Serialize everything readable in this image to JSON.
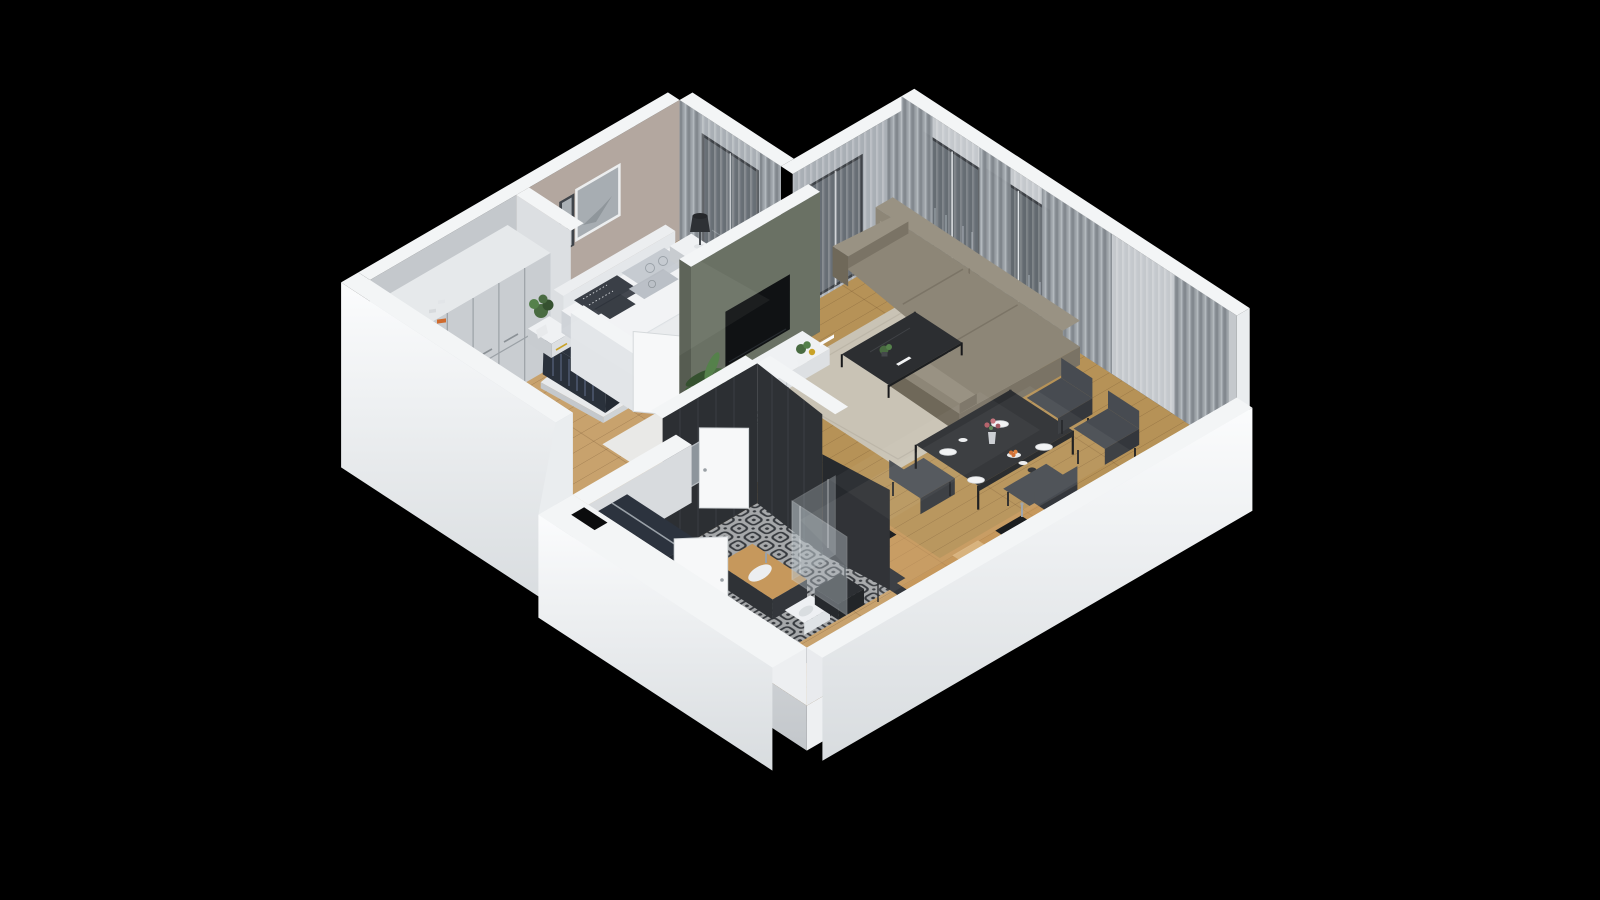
{
  "meta": {
    "kind": "isometric-3d-floor-plan-render",
    "view": "dollhouse cutaway, walls sliced, black backdrop"
  },
  "icons": {
    "freezer_icon": "❄"
  },
  "palette": {
    "bg": "#000000",
    "wallTop": "#f3f5f6",
    "wallFaceLight": "#eaedef",
    "wallFaceShade": "#d3d7db",
    "wallInner": "#c4c8cc",
    "wallInnerDark": "#a6acb2",
    "taupe": "#b3a79f",
    "olive": "#6a7164",
    "oliveDark": "#565c51",
    "woodBedroom": "#c49b66",
    "woodLiving": "#b69257",
    "woodHall": "#c8a26d",
    "plankLine": "#5a3c1e",
    "tileBase": "#c6c9cb",
    "tileInk": "#41454a",
    "rugLiving": "#c9c3b5",
    "rugBed": "#e9e9e7",
    "bedWhite": "#f2f3f5",
    "bedShade": "#d9dce0",
    "headboard": "#e4e7ea",
    "pillowDark": "#3a3f47",
    "pillowLight": "#c6cbd1",
    "sofa": "#8d8677",
    "sofaShade": "#7a7365",
    "sofaDark": "#6f6859",
    "sofaLight": "#999283",
    "tableDark": "#2c2e31",
    "chair": "#474b51",
    "chairDark": "#34373c",
    "counterWood": "#c6985c",
    "cabinetDark": "#33363b",
    "fridgeWhite": "#eef0f3",
    "fridgeShade": "#d4d8dc",
    "curtain": "#9ba1a7",
    "curtainDark": "#80868c",
    "sheerLight": "#d9dde0",
    "glass": "#5d646b",
    "glassLight": "#99a1a8",
    "frameDark": "#2e3237",
    "plantGreen": "#496b41",
    "plantDark": "#35512f",
    "potDark": "#3a3d40",
    "accentOrange": "#cf6a2d",
    "accentRed": "#a93c30",
    "denim": "#48587a",
    "clothesDark": "#2c333e",
    "metal": "#9aa1a8",
    "black": "#0b0c0d",
    "white": "#f7f8f9",
    "artGrey": "#a7adb2"
  },
  "scene": {
    "rooms": [
      {
        "name": "bedroom",
        "floor": "wood",
        "items": [
          "double-bed",
          "headboard",
          "pillows",
          "nightstand-left",
          "potted-plant",
          "nightstand-right",
          "table-lamp",
          "wall-art-frames",
          "sheer-curtains",
          "balcony-window",
          "white-rug",
          "door"
        ]
      },
      {
        "name": "walk-in-closet",
        "floor": "wood",
        "items": [
          "tall-wardrobe",
          "open-shelf-with-books",
          "clothes-rack"
        ]
      },
      {
        "name": "living-room",
        "floor": "wood",
        "items": [
          "corner-sofa",
          "coffee-table",
          "area-rug",
          "tv-sideboard",
          "tv-screen",
          "palm-plant",
          "window-wall",
          "curtains",
          "balcony-door"
        ]
      },
      {
        "name": "dining-area",
        "floor": "wood",
        "items": [
          "dining-table",
          "chairs",
          "plates",
          "flower-vase",
          "fruit-plate"
        ]
      },
      {
        "name": "kitchen",
        "floor": "wood",
        "items": [
          "fridge-with-freezer-icon",
          "cooktop-counter",
          "sink-counter",
          "cutting-board"
        ]
      },
      {
        "name": "bathroom",
        "floor": "patterned-tile",
        "items": [
          "vanity-sink",
          "mirror",
          "shower-glass",
          "toilet",
          "laundry-box",
          "door"
        ]
      },
      {
        "name": "entry-hall",
        "floor": "wood",
        "items": [
          "clothes-rack",
          "entry-door",
          "floor-shaft"
        ]
      }
    ]
  }
}
